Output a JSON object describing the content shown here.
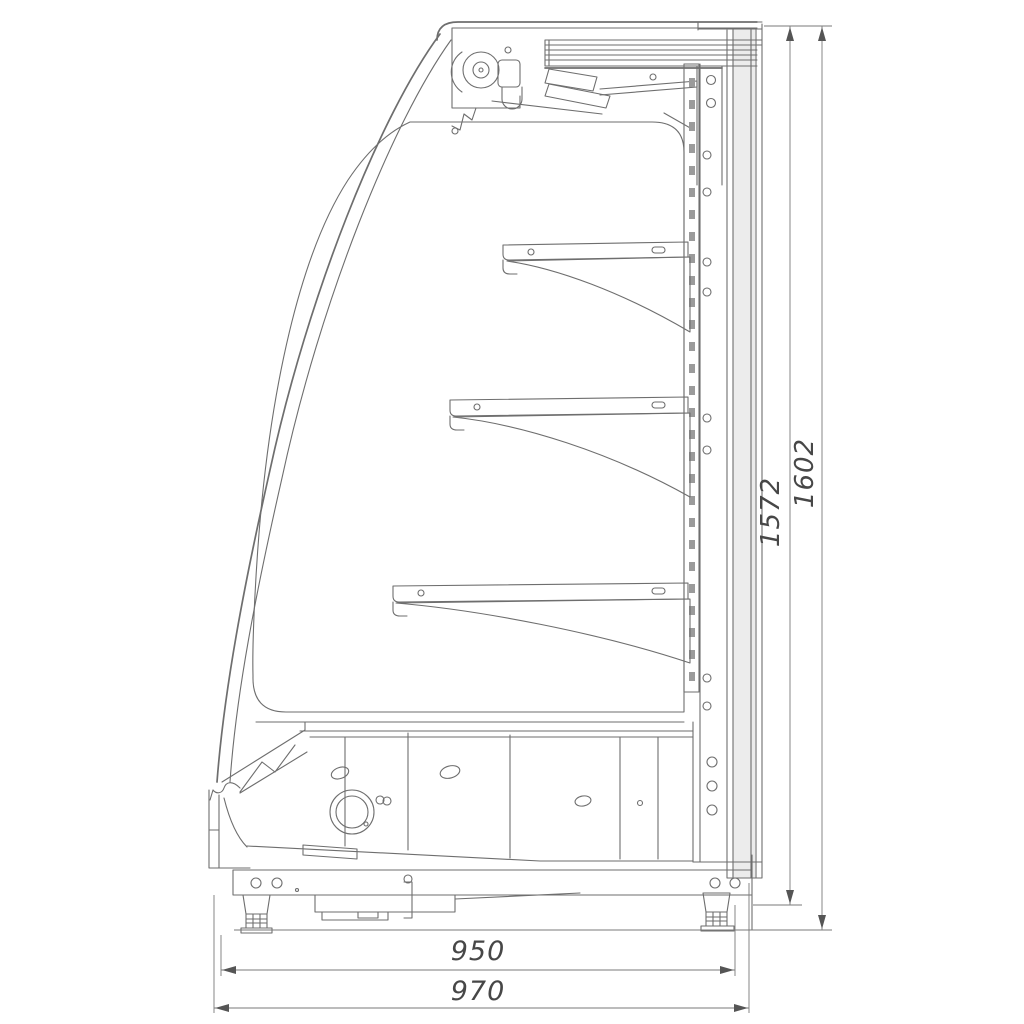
{
  "diagram": {
    "dimension_labels": {
      "inner_height": "1572",
      "total_height": "1602",
      "inner_depth": "950",
      "total_depth": "970"
    },
    "colors": {
      "background": "#ffffff",
      "line": "#6e6e6e",
      "line_light": "#9a9a9a",
      "panel_fill": "#ececec",
      "text": "#474747"
    }
  }
}
